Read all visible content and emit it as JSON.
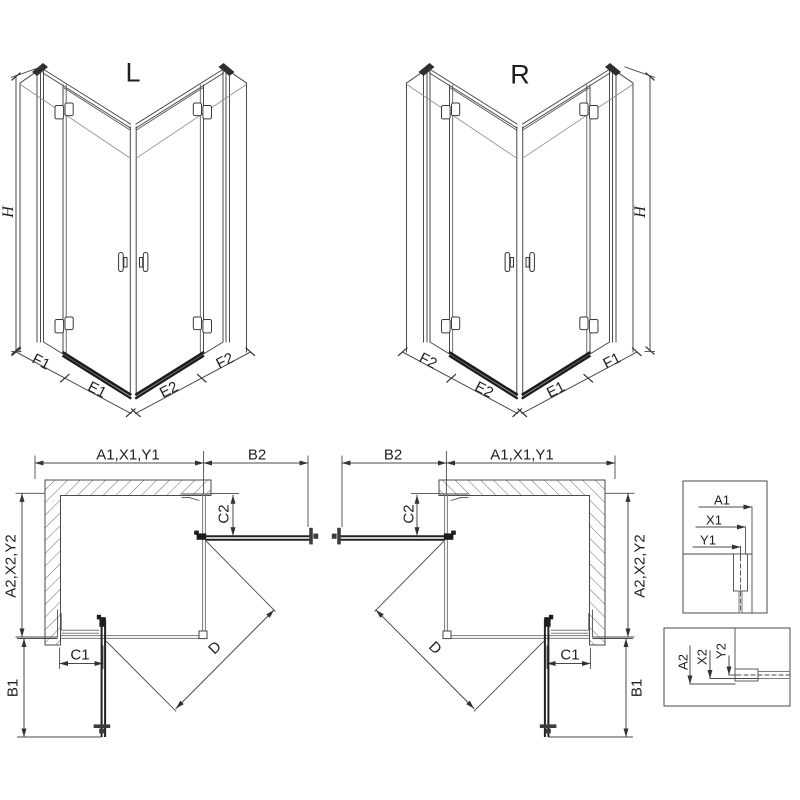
{
  "iso_left": {
    "variant": "L",
    "height": "H",
    "segments": [
      "F1",
      "E1",
      "E2",
      "F2"
    ]
  },
  "iso_right": {
    "variant": "R",
    "height": "H",
    "segments": [
      "F2",
      "E2",
      "E1",
      "F1"
    ]
  },
  "plan_left": {
    "width_top": "A1,X1,Y1",
    "door_swing_top": "B2",
    "depth_side": "A2,X2,Y2",
    "fixed_top": "C2",
    "fixed_bottom": "C1",
    "door_swing_side": "B1",
    "diagonal": "D"
  },
  "plan_right": {
    "width_top": "A1,X1,Y1",
    "door_swing_top": "B2",
    "depth_side": "A2,X2,Y2",
    "fixed_top": "C2",
    "fixed_bottom": "C1",
    "door_swing_side": "B1",
    "diagonal": "D"
  },
  "detail_wall_top": {
    "dims": [
      "A1",
      "X1",
      "Y1"
    ]
  },
  "detail_wall_bottom": {
    "dims": [
      "A2",
      "X2",
      "Y2"
    ]
  },
  "colors": {
    "line": "#4a4a4a",
    "dark": "#1b1b1b",
    "glass": "#7a7a7a",
    "text": "#1f1f1f",
    "background": "#ffffff"
  }
}
